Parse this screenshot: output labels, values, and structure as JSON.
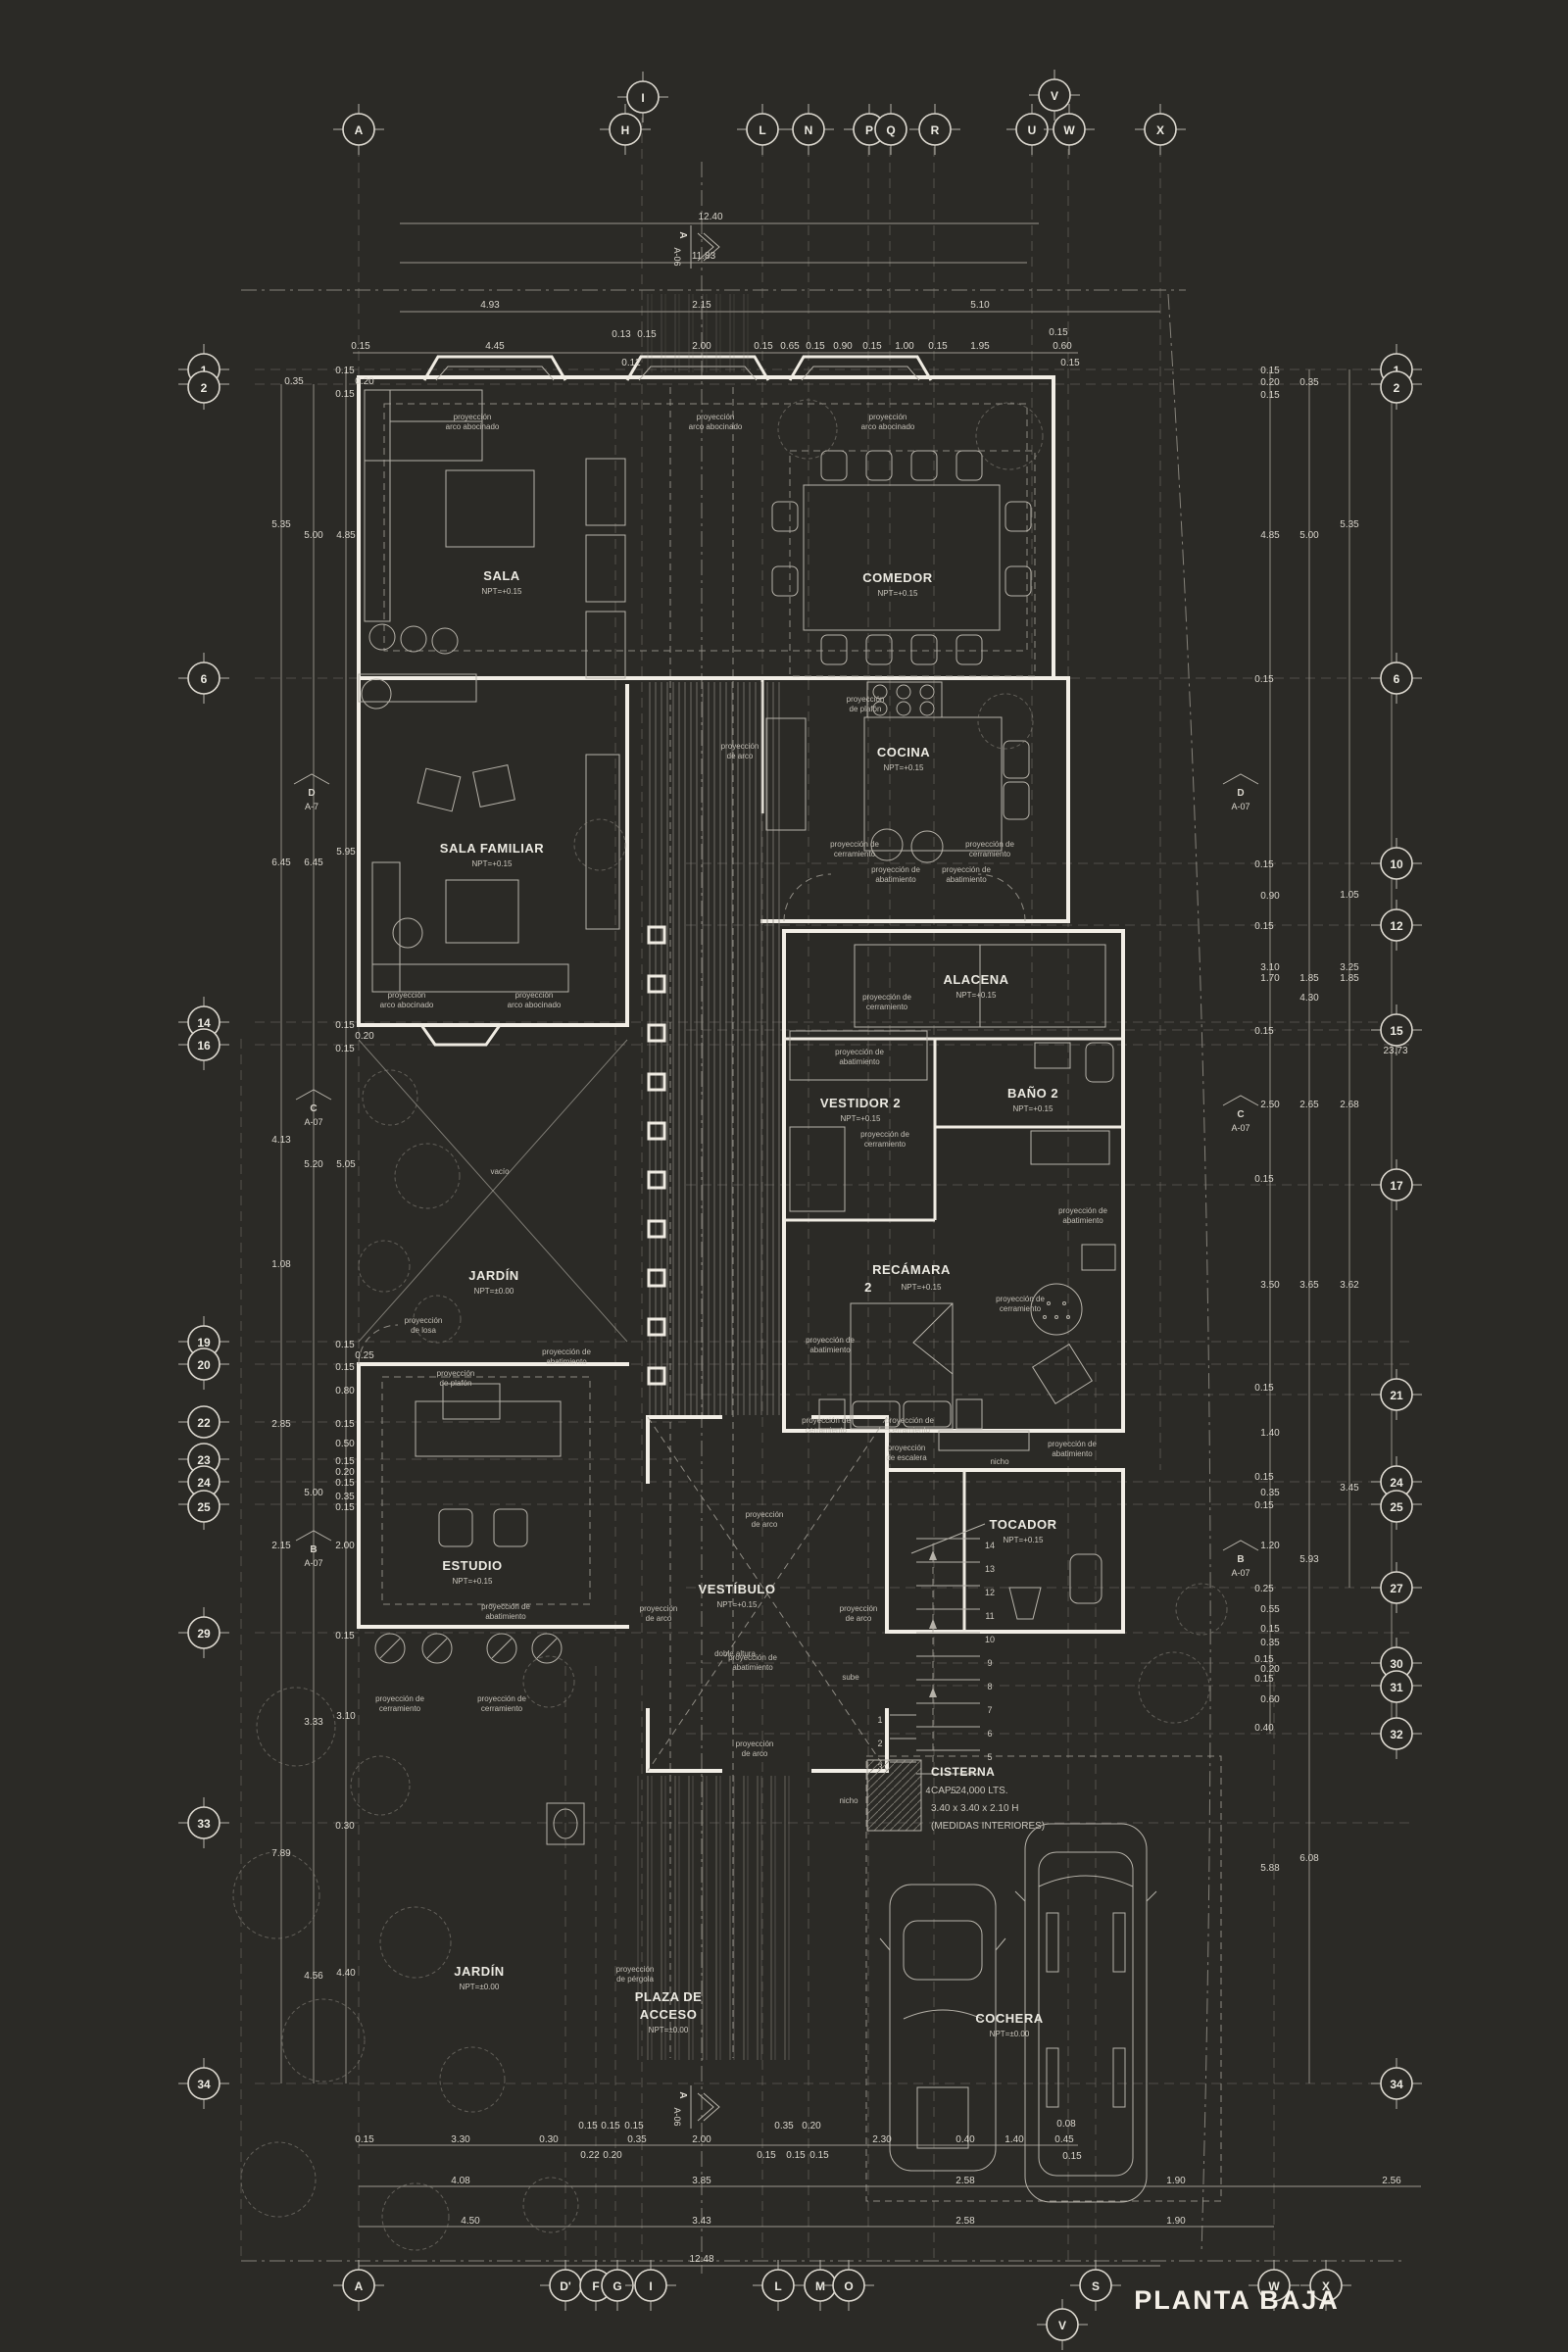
{
  "title": "PLANTA BAJA",
  "colors": {
    "bg": "#2b2a26",
    "wall": "#f2eee6",
    "thin_line": "#b6b2a9",
    "dim_text": "#d9d5cc"
  },
  "bubbles": {
    "top": [
      "A",
      "H",
      "I",
      "L",
      "N",
      "P",
      "Q",
      "R",
      "U",
      "V",
      "W",
      "X"
    ],
    "bottom": [
      "A",
      "D'",
      "F",
      "G",
      "I",
      "L",
      "M",
      "O",
      "S",
      "W",
      "X",
      "V"
    ],
    "left": [
      "1",
      "2",
      "6",
      "14",
      "16",
      "19",
      "20",
      "22",
      "23",
      "24",
      "25",
      "29",
      "33",
      "34"
    ],
    "right": [
      "1",
      "2",
      "6",
      "10",
      "12",
      "15",
      "17",
      "21",
      "24",
      "25",
      "27",
      "30",
      "31",
      "32",
      "34"
    ]
  },
  "rooms": {
    "sala": {
      "n": "SALA",
      "npt": "NPT=+0.15"
    },
    "comedor": {
      "n": "COMEDOR",
      "npt": "NPT=+0.15"
    },
    "cocina": {
      "n": "COCINA",
      "npt": "NPT=+0.15"
    },
    "sala_familiar": {
      "n": "SALA FAMILIAR",
      "npt": "NPT=+0.15"
    },
    "alacena": {
      "n": "ALACENA",
      "npt": "NPT=+0.15"
    },
    "bano2": {
      "n": "BAÑO 2",
      "npt": "NPT=+0.15"
    },
    "vestidor2": {
      "n": "VESTIDOR 2",
      "npt": "NPT=+0.15"
    },
    "recamara2": {
      "n": "RECÁMARA",
      "num": "2",
      "npt": "NPT=+0.15"
    },
    "jardin": {
      "n": "JARDÍN",
      "npt": "NPT=±0.00"
    },
    "estudio": {
      "n": "ESTUDIO",
      "npt": "NPT=+0.15"
    },
    "vestibulo": {
      "n": "VESTÍBULO",
      "npt": "NPT=+0.15"
    },
    "tocador": {
      "n": "TOCADOR",
      "npt": "NPT=+0.15"
    },
    "jardin2": {
      "n": "JARDÍN",
      "npt": "NPT=±0.00"
    },
    "plaza": {
      "l1": "PLAZA DE",
      "l2": "ACCESO",
      "npt": "NPT=±0.00"
    },
    "cochera": {
      "n": "COCHERA",
      "npt": "NPT=±0.00"
    },
    "cisterna": {
      "l1": "CISTERNA",
      "l2": "CAP. 24,000 LTS.",
      "l3": "3.40 x 3.40 x 2.10 H",
      "l4": "(MEDIDAS INTERIORES)"
    }
  },
  "ann": {
    "proy": "proyección de",
    "proy1": "proyección",
    "cerr": "cerramiento",
    "abat": "abatimiento",
    "arco": "de arco",
    "arco_ab": "arco abocinado",
    "plafon": "de plafón",
    "losa": "de losa",
    "esc": "de escalera",
    "perg": "de pérgola",
    "nicho": "nicho",
    "vacio": "vacío",
    "doble": "doble altura",
    "sube": "sube"
  },
  "markers": {
    "a": "A",
    "b": "B",
    "c": "C",
    "d": "D",
    "a06": "A-06",
    "a07": "A-07",
    "a7": "A-7"
  },
  "stairs": [
    "1",
    "2",
    "3",
    "4",
    "5",
    "6",
    "7",
    "8",
    "9",
    "10",
    "11",
    "12",
    "13",
    "14"
  ],
  "dims": {
    "top1": "12.40",
    "top2": "11.83",
    "top3": [
      "4.93",
      "2.15",
      "5.10"
    ],
    "top4": [
      "0.15",
      "4.45",
      "0.13",
      "0.15",
      "0.12",
      "2.00",
      "0.15",
      "0.65",
      "0.15",
      "0.90",
      "0.15",
      "1.00",
      "0.15",
      "1.95",
      "0.15",
      "0.60",
      "0.15"
    ],
    "left": [
      "0.35",
      "0.15",
      "0.20",
      "0.15",
      "5.35",
      "5.00",
      "4.85",
      "6.45",
      "6.45",
      "5.95",
      "0.15",
      "0.20",
      "0.15",
      "4.13",
      "5.20",
      "5.05",
      "1.08",
      "0.15",
      "0.25",
      "0.15",
      "0.80",
      "2.85",
      "0.15",
      "0.50",
      "0.15",
      "0.20",
      "0.15",
      "5.00",
      "0.35",
      "0.15",
      "2.15",
      "2.00",
      "0.15",
      "3.33",
      "3.10",
      "0.30",
      "7.89",
      "4.56",
      "4.40"
    ],
    "right": [
      "0.15",
      "0.20",
      "0.15",
      "0.35",
      "4.85",
      "5.00",
      "5.35",
      "0.15",
      "3.10",
      "4.30",
      "3.25",
      "0.15",
      "0.90",
      "1.05",
      "0.15",
      "1.70",
      "1.85",
      "1.85",
      "0.15",
      "23.73",
      "2.50",
      "2.65",
      "2.68",
      "0.15",
      "3.50",
      "3.65",
      "3.62",
      "0.15",
      "1.40",
      "0.15",
      "0.35",
      "0.15",
      "3.45",
      "1.20",
      "5.93",
      "0.25",
      "0.55",
      "0.15",
      "0.35",
      "0.15",
      "0.20",
      "0.15",
      "0.60",
      "0.40",
      "5.88",
      "6.08"
    ],
    "bottom1": [
      "0.15",
      "3.30",
      "0.30",
      "0.15",
      "0.15",
      "0.15",
      "0.22",
      "0.20",
      "0.35",
      "2.00",
      "0.15",
      "0.35",
      "0.20",
      "0.15",
      "0.15",
      "2.30",
      "0.40",
      "1.40",
      "0.08",
      "0.45",
      "0.15"
    ],
    "bottom2": [
      "4.08",
      "3.85",
      "2.58",
      "1.90",
      "2.56"
    ],
    "bottom3": [
      "4.50",
      "3.43",
      "2.58",
      "1.90"
    ],
    "bottom4": "12.48"
  }
}
